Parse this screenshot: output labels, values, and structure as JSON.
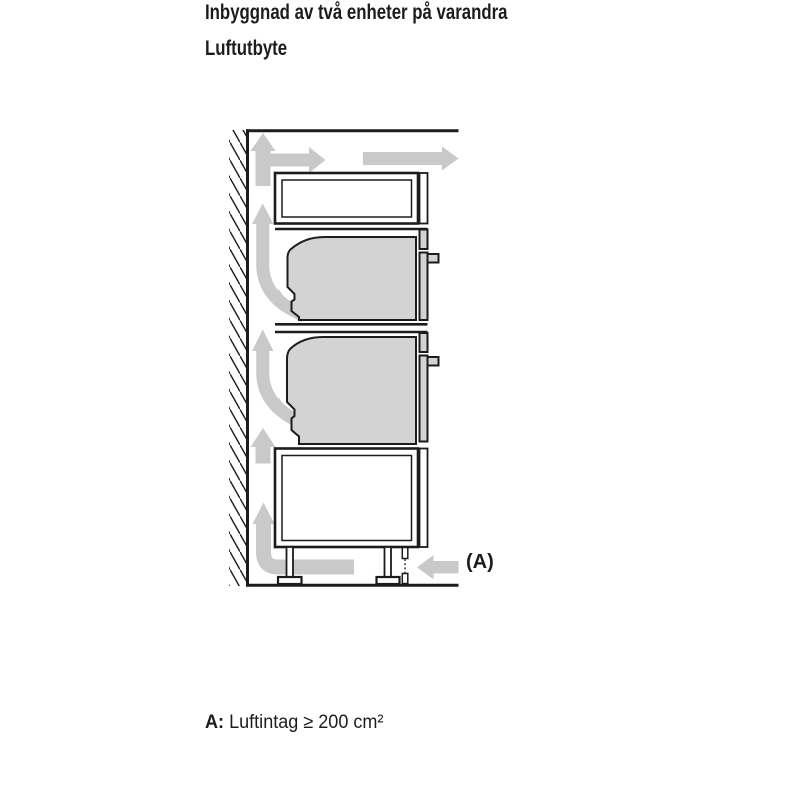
{
  "heading": {
    "title": "Inbyggnad av två enheter på varandra",
    "subtitle": "Luftutbyte"
  },
  "diagram": {
    "air_intake_label": "(A)",
    "colors": {
      "outline": "#1c1c1c",
      "unit_fill": "#d3d3d3",
      "arrow_fill": "#c9c9c9"
    }
  },
  "caption": {
    "prefix": "A:",
    "text": "Luftintag ≥ 200 cm²"
  }
}
